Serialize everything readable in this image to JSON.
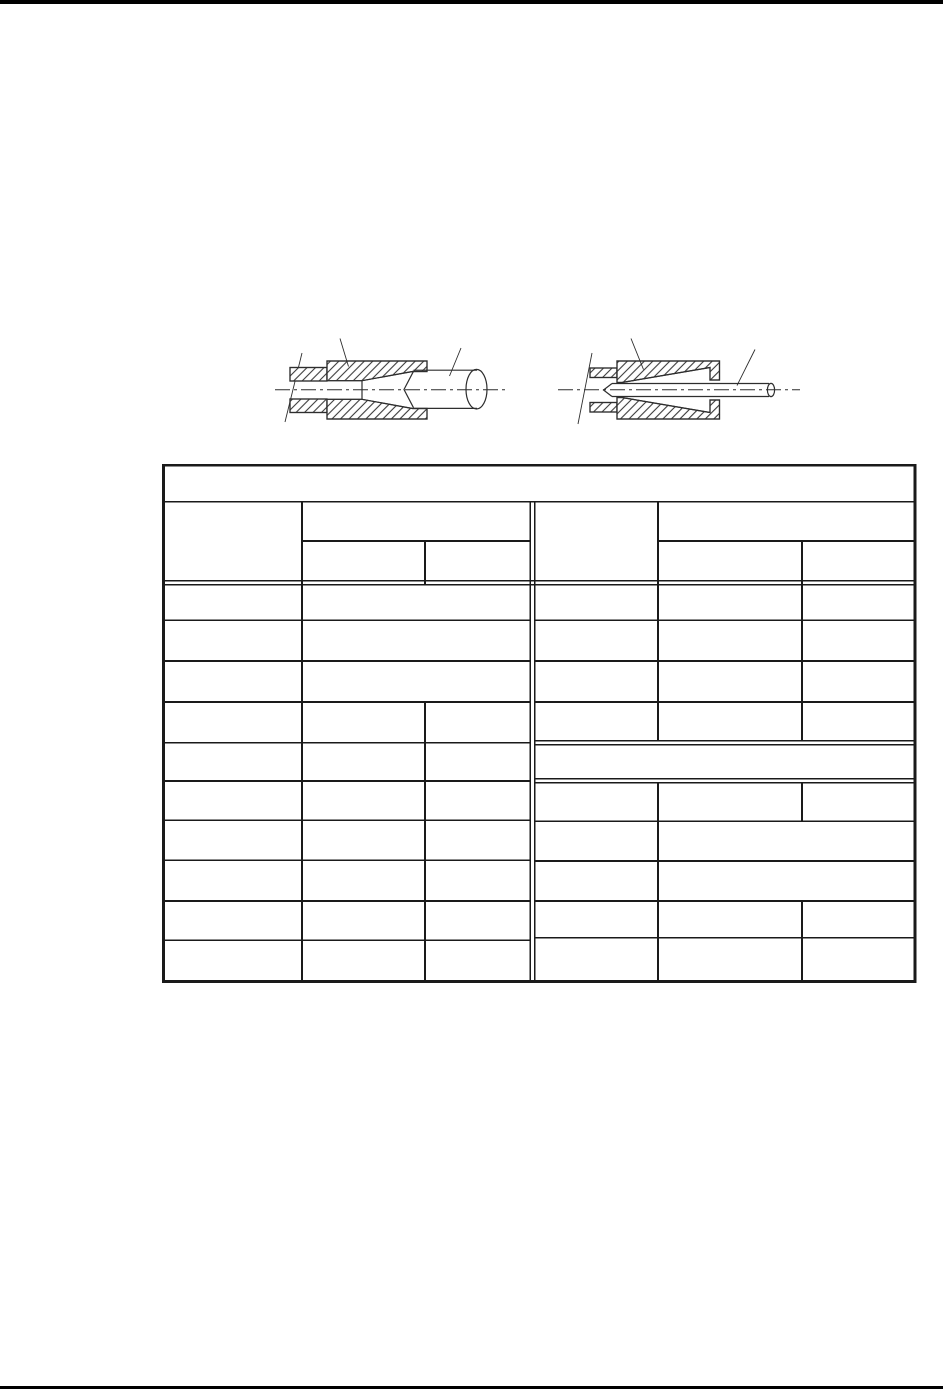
{
  "page": {
    "bg_color": "#ffffff",
    "ink_color": "#1a1a1a",
    "figure_ink_color": "#2e2e2e",
    "hatch_color": "#3a3a3a",
    "top_bar_color": "#000000",
    "bottom_rule_color": "#000000"
  },
  "table": {
    "title_cell_text": ""
  },
  "figures": {
    "left_name": "compression-gland-cross-section-large-cable",
    "right_name": "compression-gland-cross-section-small-cable"
  }
}
